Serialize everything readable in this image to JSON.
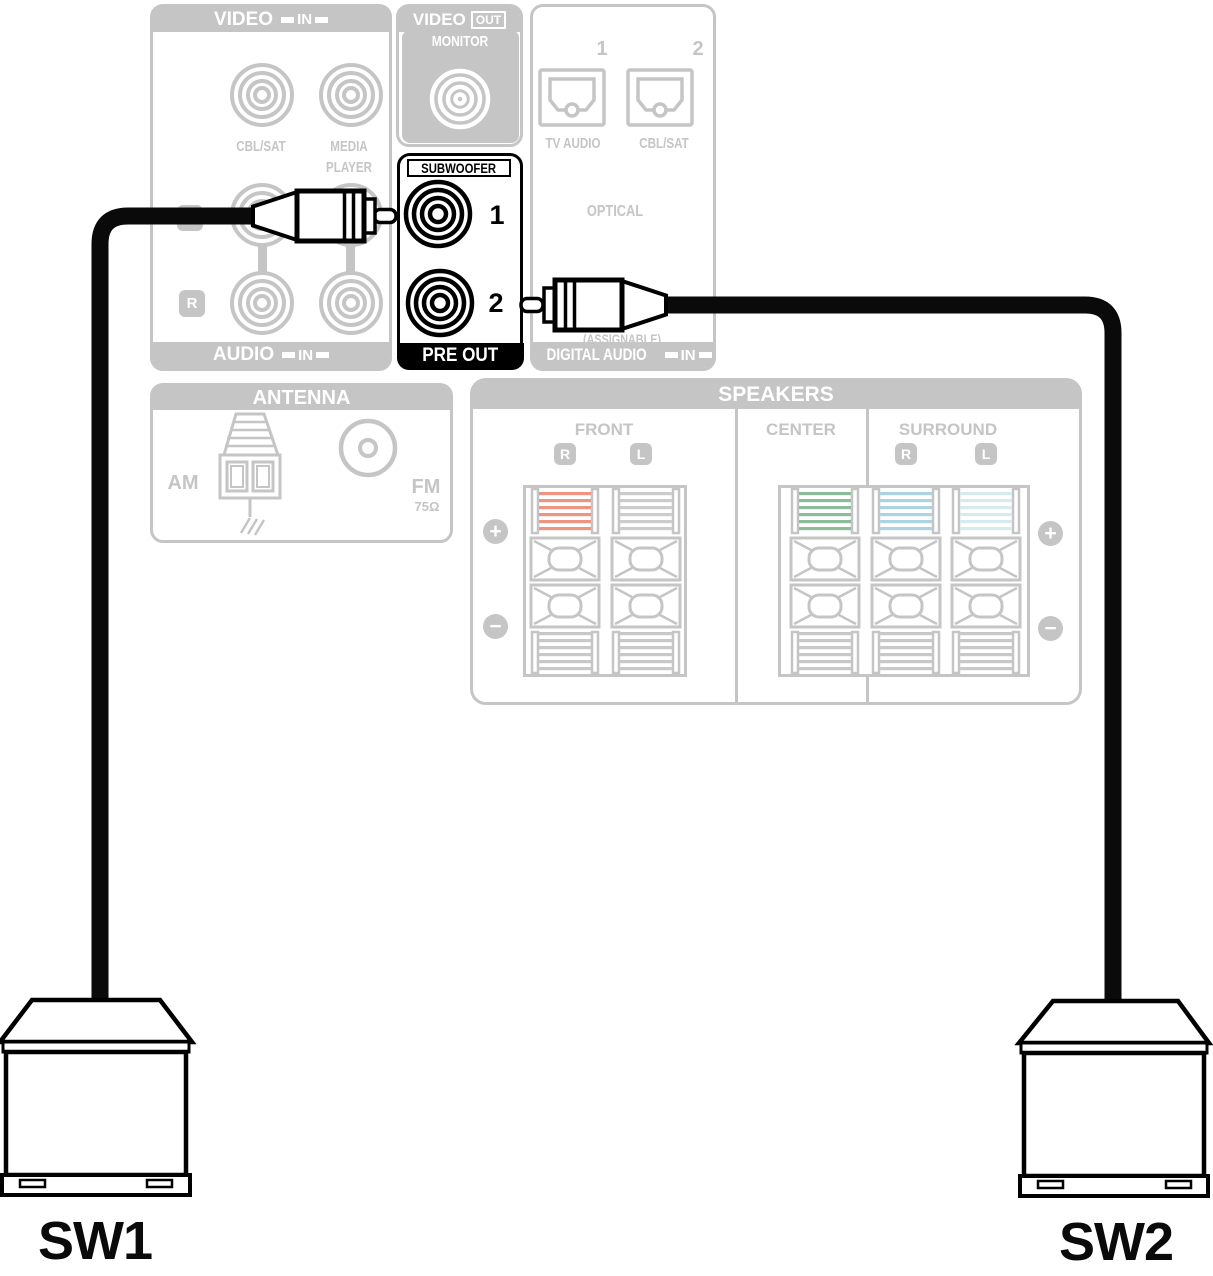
{
  "panels": {
    "video_in": {
      "title": "VIDEO",
      "io_badge": "IN",
      "jack1_label": "CBL/SAT",
      "jack2_label_line1": "MEDIA",
      "jack2_label_line2": "PLAYER",
      "left_channel": "L",
      "right_channel": "R",
      "footer_title": "AUDIO",
      "footer_badge": "IN"
    },
    "video_out": {
      "title": "VIDEO",
      "io_badge": "OUT",
      "monitor_label": "MONITOR"
    },
    "subwoofer_pre_out": {
      "title": "SUBWOOFER",
      "jack1_number": "1",
      "jack2_number": "2",
      "footer": "PRE OUT"
    },
    "digital_audio": {
      "jack1_number": "1",
      "jack2_number": "2",
      "jack1_label": "TV AUDIO",
      "jack2_label": "CBL/SAT",
      "connection_type": "OPTICAL",
      "assignable_note": "(ASSIGNABLE)",
      "footer_title": "DIGITAL AUDIO",
      "footer_badge": "IN"
    },
    "antenna": {
      "title": "ANTENNA",
      "am_label": "AM",
      "fm_label": "FM",
      "fm_impedance": "75Ω"
    },
    "speakers": {
      "title": "SPEAKERS",
      "front_label": "FRONT",
      "center_label": "CENTER",
      "surround_label": "SURROUND",
      "front_right": "R",
      "front_left": "L",
      "surround_right": "R",
      "surround_left": "L",
      "plus": "+",
      "minus": "−"
    }
  },
  "subwoofers": {
    "sw1_label": "SW1",
    "sw2_label": "SW2"
  },
  "colors": {
    "front_right_terminal": "#ef9480",
    "front_left_terminal": "#cccccc",
    "center_terminal": "#8cbc9c",
    "surround_right_terminal": "#abd3e2",
    "surround_left_terminal": "#d7eaf0",
    "stripe_gray": "#c8c8c8",
    "panel_gray": "#c5c5c5",
    "cable_black": "#0a0a0a"
  }
}
